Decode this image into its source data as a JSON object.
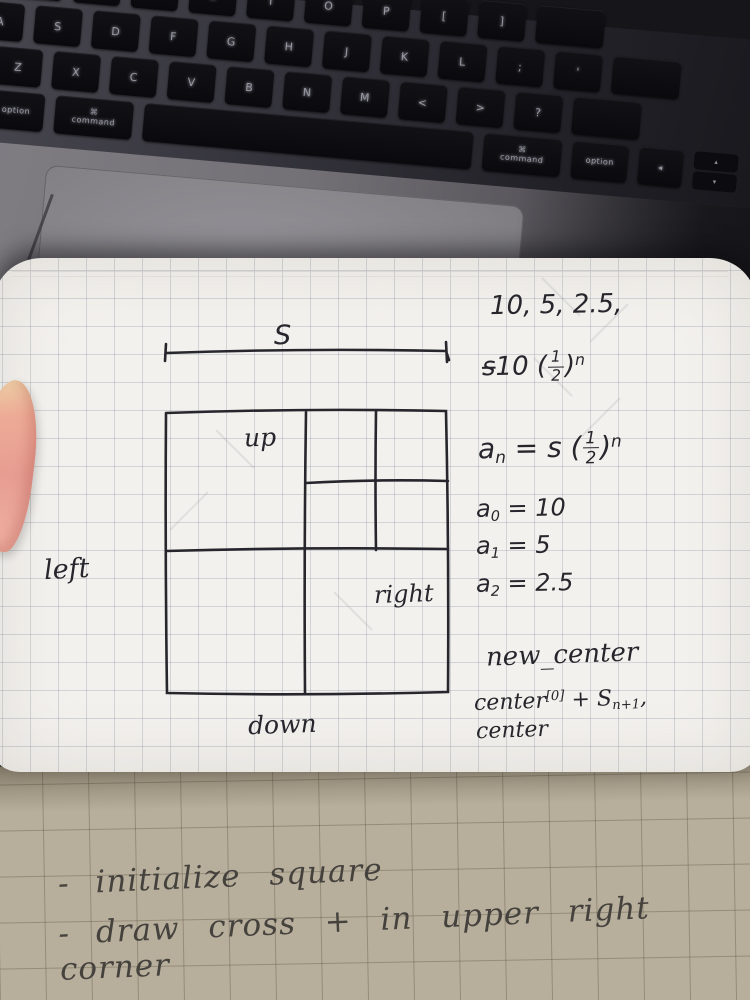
{
  "keyboard": {
    "row_top": [
      "E",
      "R",
      "T",
      "Y",
      "U",
      "I",
      "O",
      "P",
      "[",
      "]",
      ""
    ],
    "row_home": [
      "A",
      "S",
      "D",
      "F",
      "G",
      "H",
      "J",
      "K",
      "L",
      ";",
      "'",
      ""
    ],
    "row_bottom": [
      "Z",
      "X",
      "C",
      "V",
      "B",
      "N",
      "M",
      "<",
      ">",
      "?",
      ""
    ],
    "modifiers": {
      "caret": "^",
      "option": "option",
      "command": "command",
      "cmd_symbol": "⌘",
      "arrow_left": "◂",
      "arrow_up": "▴",
      "arrow_down": "▾"
    }
  },
  "page": {
    "dimension_label": "S",
    "labels": {
      "up": "up",
      "down": "down",
      "left": "left",
      "right": "right"
    },
    "notes": {
      "sequence": "10, 5, 2.5,",
      "scratch": {
        "crossed": "s",
        "prefix": "10 (",
        "num": "1",
        "den": "2",
        "close": ")",
        "exp": "n"
      },
      "formula": {
        "lhs": "a",
        "lhs_sub": "n",
        "eq": " = s (",
        "num": "1",
        "den": "2",
        "close": ")",
        "exp": "n"
      },
      "terms": [
        {
          "v": "a",
          "sub": "0",
          "rhs": " = 10"
        },
        {
          "v": "a",
          "sub": "1",
          "rhs": " = 5"
        },
        {
          "v": "a",
          "sub": "2",
          "rhs": " = 2.5"
        }
      ],
      "new_center": "new_center",
      "center_formula": {
        "base": "center",
        "sup": "[0]",
        "mid": " + S",
        "sub": "n+1",
        "tail": ","
      },
      "center_formula_line2": "center"
    }
  },
  "bottom_page": {
    "bullets": [
      {
        "dash": "-",
        "text": "initialize square"
      },
      {
        "dash": "-",
        "text": "draw cross + in upper right corner"
      }
    ]
  },
  "colors": {
    "ink": "#26262c",
    "white_page": "#f3f1ed",
    "tan_page": "#b7ae9b",
    "key": "#0c0c10"
  }
}
